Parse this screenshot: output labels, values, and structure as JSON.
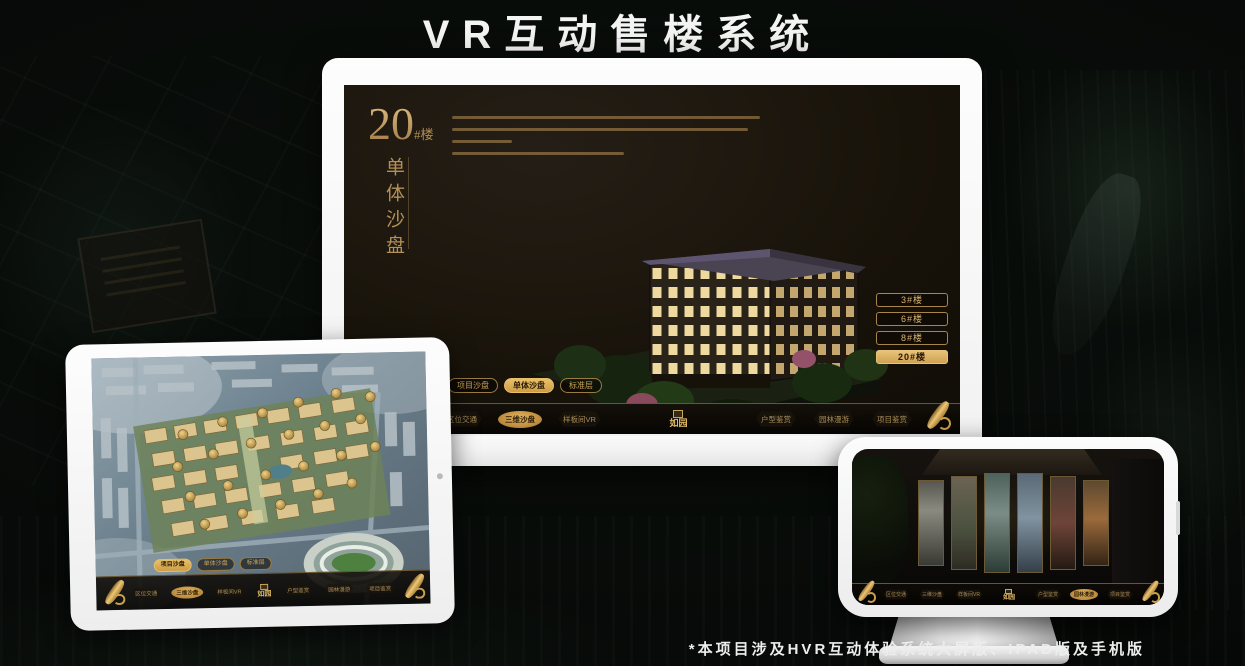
{
  "title": "VR互动售楼系统",
  "footnote": "*本项目涉及HVR互动体验系统大屏版、IPAD版及手机版",
  "colors": {
    "gold": "#c9a467",
    "gold_bright": "#e3b45c",
    "screen_bg": "#171209"
  },
  "logo": {
    "name": "如园"
  },
  "monitor": {
    "building_no": "20",
    "building_suffix": "#楼",
    "panel_title": "单体沙盘",
    "desc_line_widths": [
      308,
      296,
      60,
      172
    ],
    "floor_buttons": [
      {
        "label": "3#楼"
      },
      {
        "label": "6#楼"
      },
      {
        "label": "8#楼"
      },
      {
        "label": "20#楼",
        "active": true
      }
    ],
    "tabs": [
      {
        "label": "项目沙盘"
      },
      {
        "label": "单体沙盘",
        "active": true
      },
      {
        "label": "标准层"
      }
    ],
    "nav_left": [
      {
        "label": "区位交通"
      },
      {
        "label": "三维沙盘",
        "active": true
      },
      {
        "label": "样板间VR"
      }
    ],
    "nav_right": [
      {
        "label": "户型鉴赏"
      },
      {
        "label": "园林漫游"
      },
      {
        "label": "项目鉴赏"
      }
    ]
  },
  "tablet": {
    "tabs": [
      {
        "label": "项目沙盘",
        "active": true
      },
      {
        "label": "单体沙盘"
      },
      {
        "label": "标准层"
      }
    ],
    "nav_left": [
      {
        "label": "区位交通"
      },
      {
        "label": "三维沙盘",
        "active": true
      },
      {
        "label": "样板间VR"
      }
    ],
    "nav_right": [
      {
        "label": "户型鉴赏"
      },
      {
        "label": "园林漫游"
      },
      {
        "label": "项目鉴赏"
      }
    ]
  },
  "phone": {
    "nav_left": [
      {
        "label": "区位交通"
      },
      {
        "label": "三维沙盘"
      },
      {
        "label": "样板间VR"
      }
    ],
    "nav_right": [
      {
        "label": "户型鉴赏"
      },
      {
        "label": "园林漫游",
        "active": true
      },
      {
        "label": "项目鉴赏"
      }
    ]
  }
}
